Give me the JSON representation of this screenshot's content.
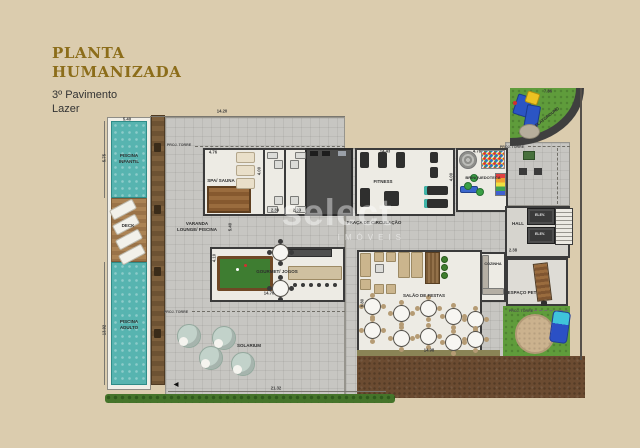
{
  "header": {
    "title_line1": "PLANTA",
    "title_line2": "HUMANIZADA",
    "subtitle_line1": "3º Pavimento",
    "subtitle_line2": "Lazer"
  },
  "watermark": {
    "brand": "select",
    "sub": "IMÓVEIS"
  },
  "colors": {
    "background": "#dbccae",
    "title_gold": "#8c6d1a",
    "pool_teal": "#57b4b0",
    "grass_green": "#5f9c3b",
    "wood_brown": "#8a6540",
    "wall_dark": "#3b3b3b",
    "tile_gray": "#c7c6c2"
  },
  "plan": {
    "texts": [
      {
        "name": "label-piscina-infantil",
        "text": "PISCINA\nINFANTIL",
        "x": 129,
        "y": 159,
        "size": 4.5
      },
      {
        "name": "label-deck",
        "text": "DECK",
        "x": 128,
        "y": 226,
        "size": 4.5
      },
      {
        "name": "label-piscina-adulto",
        "text": "PISCINA\nADULTO",
        "x": 129,
        "y": 325,
        "size": 4.5
      },
      {
        "name": "label-varanda-lounge-piscina",
        "text": "VARANDA\nLOUNGE/ PISCINA",
        "x": 197,
        "y": 227,
        "size": 4.5
      },
      {
        "name": "label-spa-sauna",
        "text": "SPA/ SAUNA",
        "x": 221,
        "y": 181,
        "size": 4.5
      },
      {
        "name": "label-fitness",
        "text": "FITNESS",
        "x": 383,
        "y": 182,
        "size": 4.5
      },
      {
        "name": "label-brinquedoteca",
        "text": "BRINQUEDOTECA",
        "x": 483,
        "y": 178,
        "size": 4
      },
      {
        "name": "label-praca-de-circulacao",
        "text": "PRAÇA DE CIRCULAÇÃO",
        "x": 374,
        "y": 223,
        "size": 4.5
      },
      {
        "name": "label-gourmet-jogos",
        "text": "GOURMET/ JOGOS",
        "x": 277,
        "y": 272,
        "size": 4.5
      },
      {
        "name": "label-salao-de-festas",
        "text": "SALÃO DE FESTAS",
        "x": 424,
        "y": 296,
        "size": 4.5
      },
      {
        "name": "label-cozinha",
        "text": "COZINHA",
        "x": 493,
        "y": 264,
        "size": 3.8
      },
      {
        "name": "label-hall",
        "text": "HALL",
        "x": 518,
        "y": 224,
        "size": 4.5
      },
      {
        "name": "label-elev-1",
        "text": "ELEV.",
        "x": 540,
        "y": 215,
        "size": 3.6,
        "color": "#e8e8e8"
      },
      {
        "name": "label-elev-2",
        "text": "ELEV.",
        "x": 540,
        "y": 234,
        "size": 3.6,
        "color": "#e8e8e8"
      },
      {
        "name": "label-espaco-pet",
        "text": "ESPAÇO PET",
        "x": 522,
        "y": 293,
        "size": 4.5
      },
      {
        "name": "label-playground",
        "text": "PLAYGROUND",
        "x": 547,
        "y": 117,
        "size": 4.2,
        "rot": -38
      },
      {
        "name": "label-solarium",
        "text": "SOLARIUM",
        "x": 249,
        "y": 346,
        "size": 4.5
      },
      {
        "name": "label-proj-torre-1",
        "text": "PROJ. TORRE",
        "x": 179,
        "y": 145,
        "size": 3.6,
        "color": "#4a4a4a"
      },
      {
        "name": "label-proj-torre-2",
        "text": "PROJ. TORRE",
        "x": 176,
        "y": 312,
        "size": 3.6,
        "color": "#4a4a4a"
      },
      {
        "name": "label-proj-torre-3",
        "text": "PROJ. TORRE",
        "x": 512,
        "y": 147,
        "size": 3.6,
        "color": "#4a4a4a"
      },
      {
        "name": "label-proj-torre-4",
        "text": "PROJ. TORRE",
        "x": 521,
        "y": 311,
        "size": 3.6,
        "color": "#4a4a4a"
      },
      {
        "name": "dim-14-20",
        "text": "14.20",
        "x": 222,
        "y": 111,
        "size": 4.2,
        "color": "#3a3a3a"
      },
      {
        "name": "dim-5-40-pool",
        "text": "5.40",
        "x": 127,
        "y": 119,
        "size": 4.2,
        "color": "#3a3a3a"
      },
      {
        "name": "dim-5-75",
        "text": "5.75",
        "x": 104,
        "y": 158,
        "size": 4.2,
        "rot": -90,
        "color": "#3a3a3a"
      },
      {
        "name": "dim-13-92",
        "text": "13.92",
        "x": 104,
        "y": 330,
        "size": 4.2,
        "rot": -90,
        "color": "#3a3a3a"
      },
      {
        "name": "dim-4-76",
        "text": "4.76",
        "x": 213,
        "y": 152,
        "size": 4.2,
        "color": "#3a3a3a"
      },
      {
        "name": "dim-4-00-wc",
        "text": "4.00",
        "x": 259,
        "y": 171,
        "size": 4.2,
        "rot": -90,
        "color": "#3a3a3a"
      },
      {
        "name": "dim-2-39-a",
        "text": "2.39",
        "x": 275,
        "y": 210,
        "size": 4.2,
        "color": "#3a3a3a"
      },
      {
        "name": "dim-2-39-b",
        "text": "2.39",
        "x": 297,
        "y": 210,
        "size": 4.2,
        "color": "#3a3a3a"
      },
      {
        "name": "dim-14-43",
        "text": "14.43",
        "x": 385,
        "y": 151,
        "size": 4.2,
        "color": "#3a3a3a"
      },
      {
        "name": "dim-4-00-fitness",
        "text": "4.00",
        "x": 451,
        "y": 177,
        "size": 4.2,
        "rot": -90,
        "color": "#3a3a3a"
      },
      {
        "name": "dim-4-78",
        "text": "4.78",
        "x": 477,
        "y": 151,
        "size": 4.2,
        "color": "#3a3a3a"
      },
      {
        "name": "dim-7-86",
        "text": "7.86",
        "x": 548,
        "y": 91,
        "size": 4.2,
        "color": "#3a3a3a"
      },
      {
        "name": "dim-5-40-varanda",
        "text": "5.40",
        "x": 230,
        "y": 227,
        "size": 4.2,
        "rot": -90,
        "color": "#3a3a3a"
      },
      {
        "name": "dim-4-10",
        "text": "4.10",
        "x": 214,
        "y": 258,
        "size": 4.2,
        "rot": -90,
        "color": "#3a3a3a"
      },
      {
        "name": "dim-14-70",
        "text": "14.70",
        "x": 269,
        "y": 293,
        "size": 4.2,
        "color": "#3a3a3a"
      },
      {
        "name": "dim-9-80",
        "text": "9.80",
        "x": 362,
        "y": 303,
        "size": 4.2,
        "rot": -90,
        "color": "#3a3a3a"
      },
      {
        "name": "dim-14-98",
        "text": "14.98",
        "x": 429,
        "y": 350,
        "size": 4.2,
        "color": "#3a3a3a"
      },
      {
        "name": "dim-2-38",
        "text": "2.38",
        "x": 513,
        "y": 250,
        "size": 4.2,
        "color": "#3a3a3a"
      },
      {
        "name": "dim-21-32",
        "text": "21.32",
        "x": 276,
        "y": 388,
        "size": 4.2,
        "color": "#3a3a3a"
      },
      {
        "name": "north-arrow-icon",
        "text": "◀",
        "x": 176,
        "y": 386,
        "size": 6,
        "color": "#111"
      }
    ]
  }
}
